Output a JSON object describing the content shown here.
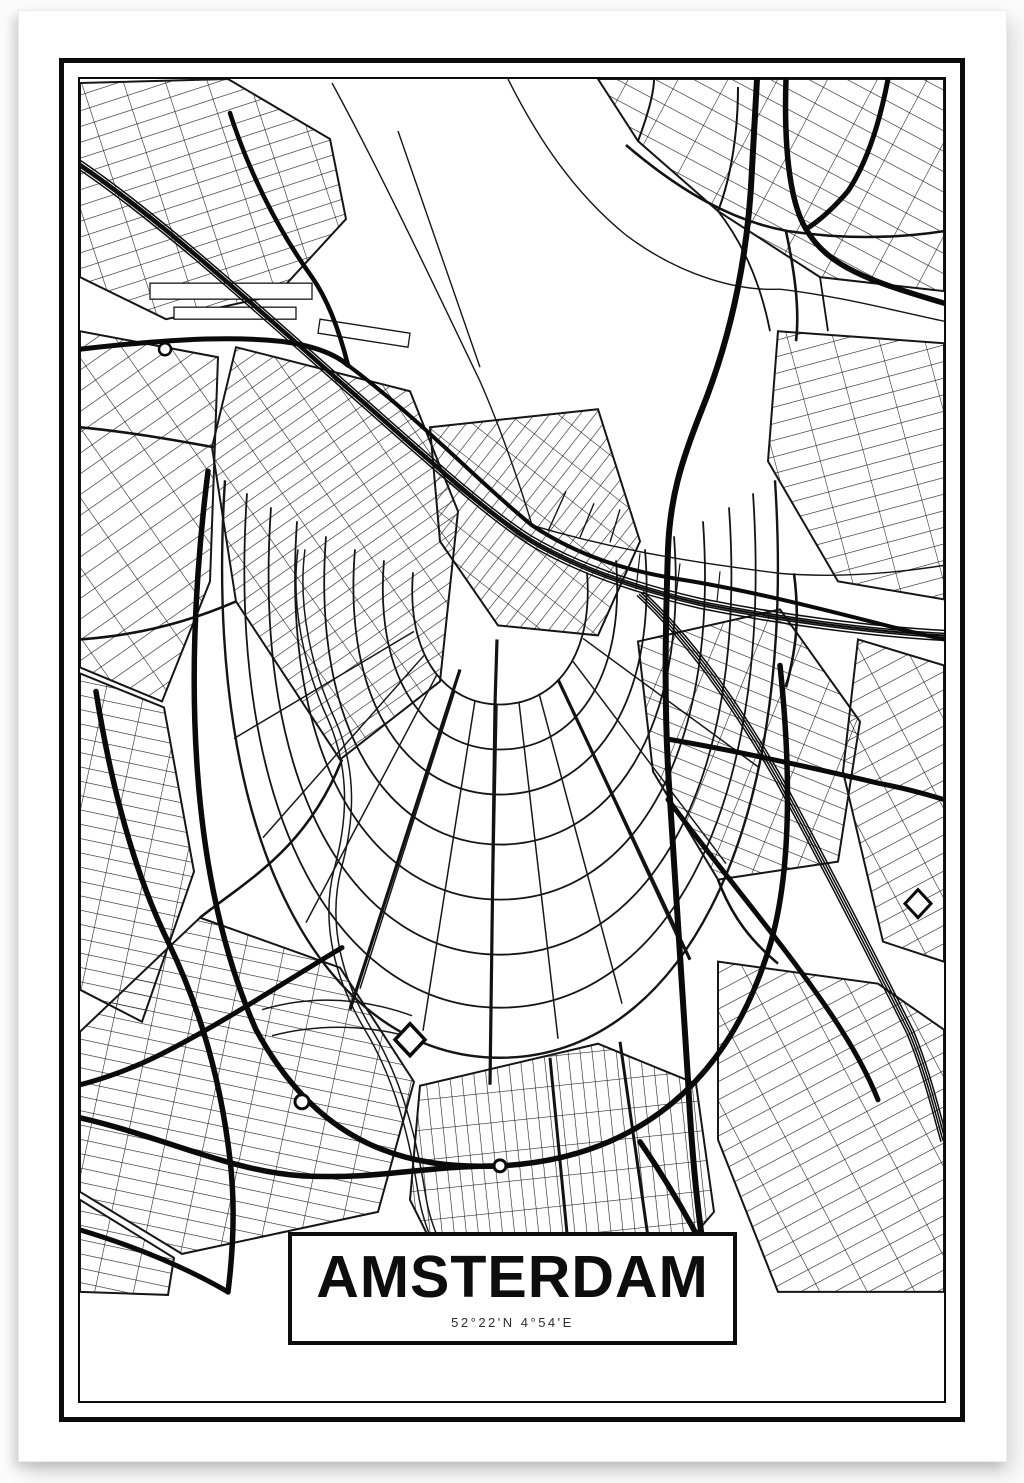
{
  "poster": {
    "title": "AMSTERDAM",
    "coordinates": "52°22'N 4°54'E",
    "city": "Amsterdam",
    "ink_color": "#111111",
    "paper_color": "#ffffff"
  }
}
